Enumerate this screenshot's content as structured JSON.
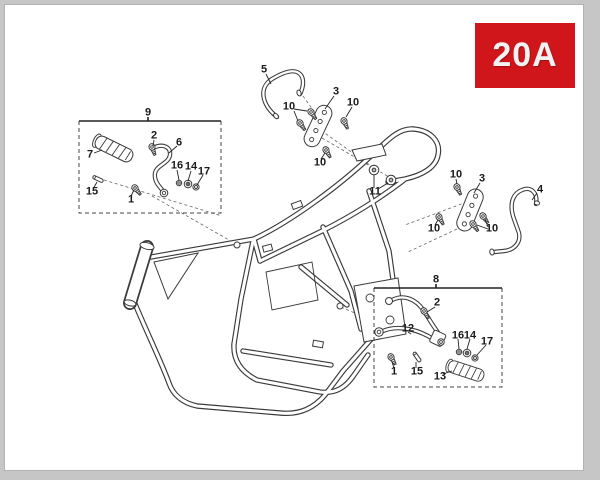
{
  "page": {
    "code_badge": "20A"
  },
  "colors": {
    "badge_bg": "#d0161b",
    "badge_text": "#f2f2f2",
    "line_art": "#3a3a3a",
    "page_bg": "#ffffff",
    "chrome_gray": "#c6c6c6"
  },
  "diagram": {
    "type": "exploded-parts-diagram",
    "subject": "motorcycle frame with footrest and carrier brackets",
    "detail_boxes": [
      {
        "label": "9"
      },
      {
        "label": "8"
      }
    ],
    "callouts": [
      {
        "label": "9",
        "x": 148,
        "y": 113
      },
      {
        "label": "7",
        "x": 90,
        "y": 155
      },
      {
        "label": "2",
        "x": 154,
        "y": 136
      },
      {
        "label": "6",
        "x": 179,
        "y": 143
      },
      {
        "label": "16",
        "x": 177,
        "y": 166
      },
      {
        "label": "14",
        "x": 191,
        "y": 167
      },
      {
        "label": "17",
        "x": 204,
        "y": 172
      },
      {
        "label": "15",
        "x": 92,
        "y": 192
      },
      {
        "label": "1",
        "x": 131,
        "y": 200
      },
      {
        "label": "5",
        "x": 264,
        "y": 70
      },
      {
        "label": "10",
        "x": 289,
        "y": 107
      },
      {
        "label": "3",
        "x": 336,
        "y": 92
      },
      {
        "label": "10",
        "x": 353,
        "y": 103
      },
      {
        "label": "10",
        "x": 320,
        "y": 163
      },
      {
        "label": "11",
        "x": 375,
        "y": 192
      },
      {
        "label": "10",
        "x": 456,
        "y": 175
      },
      {
        "label": "3",
        "x": 482,
        "y": 179
      },
      {
        "label": "10",
        "x": 434,
        "y": 229
      },
      {
        "label": "10",
        "x": 492,
        "y": 229
      },
      {
        "label": "4",
        "x": 540,
        "y": 190
      },
      {
        "label": "8",
        "x": 436,
        "y": 280
      },
      {
        "label": "2",
        "x": 437,
        "y": 303
      },
      {
        "label": "12",
        "x": 408,
        "y": 329
      },
      {
        "label": "16",
        "x": 458,
        "y": 336
      },
      {
        "label": "14",
        "x": 470,
        "y": 336
      },
      {
        "label": "17",
        "x": 487,
        "y": 342
      },
      {
        "label": "1",
        "x": 394,
        "y": 372
      },
      {
        "label": "15",
        "x": 417,
        "y": 372
      },
      {
        "label": "13",
        "x": 440,
        "y": 377
      }
    ]
  }
}
